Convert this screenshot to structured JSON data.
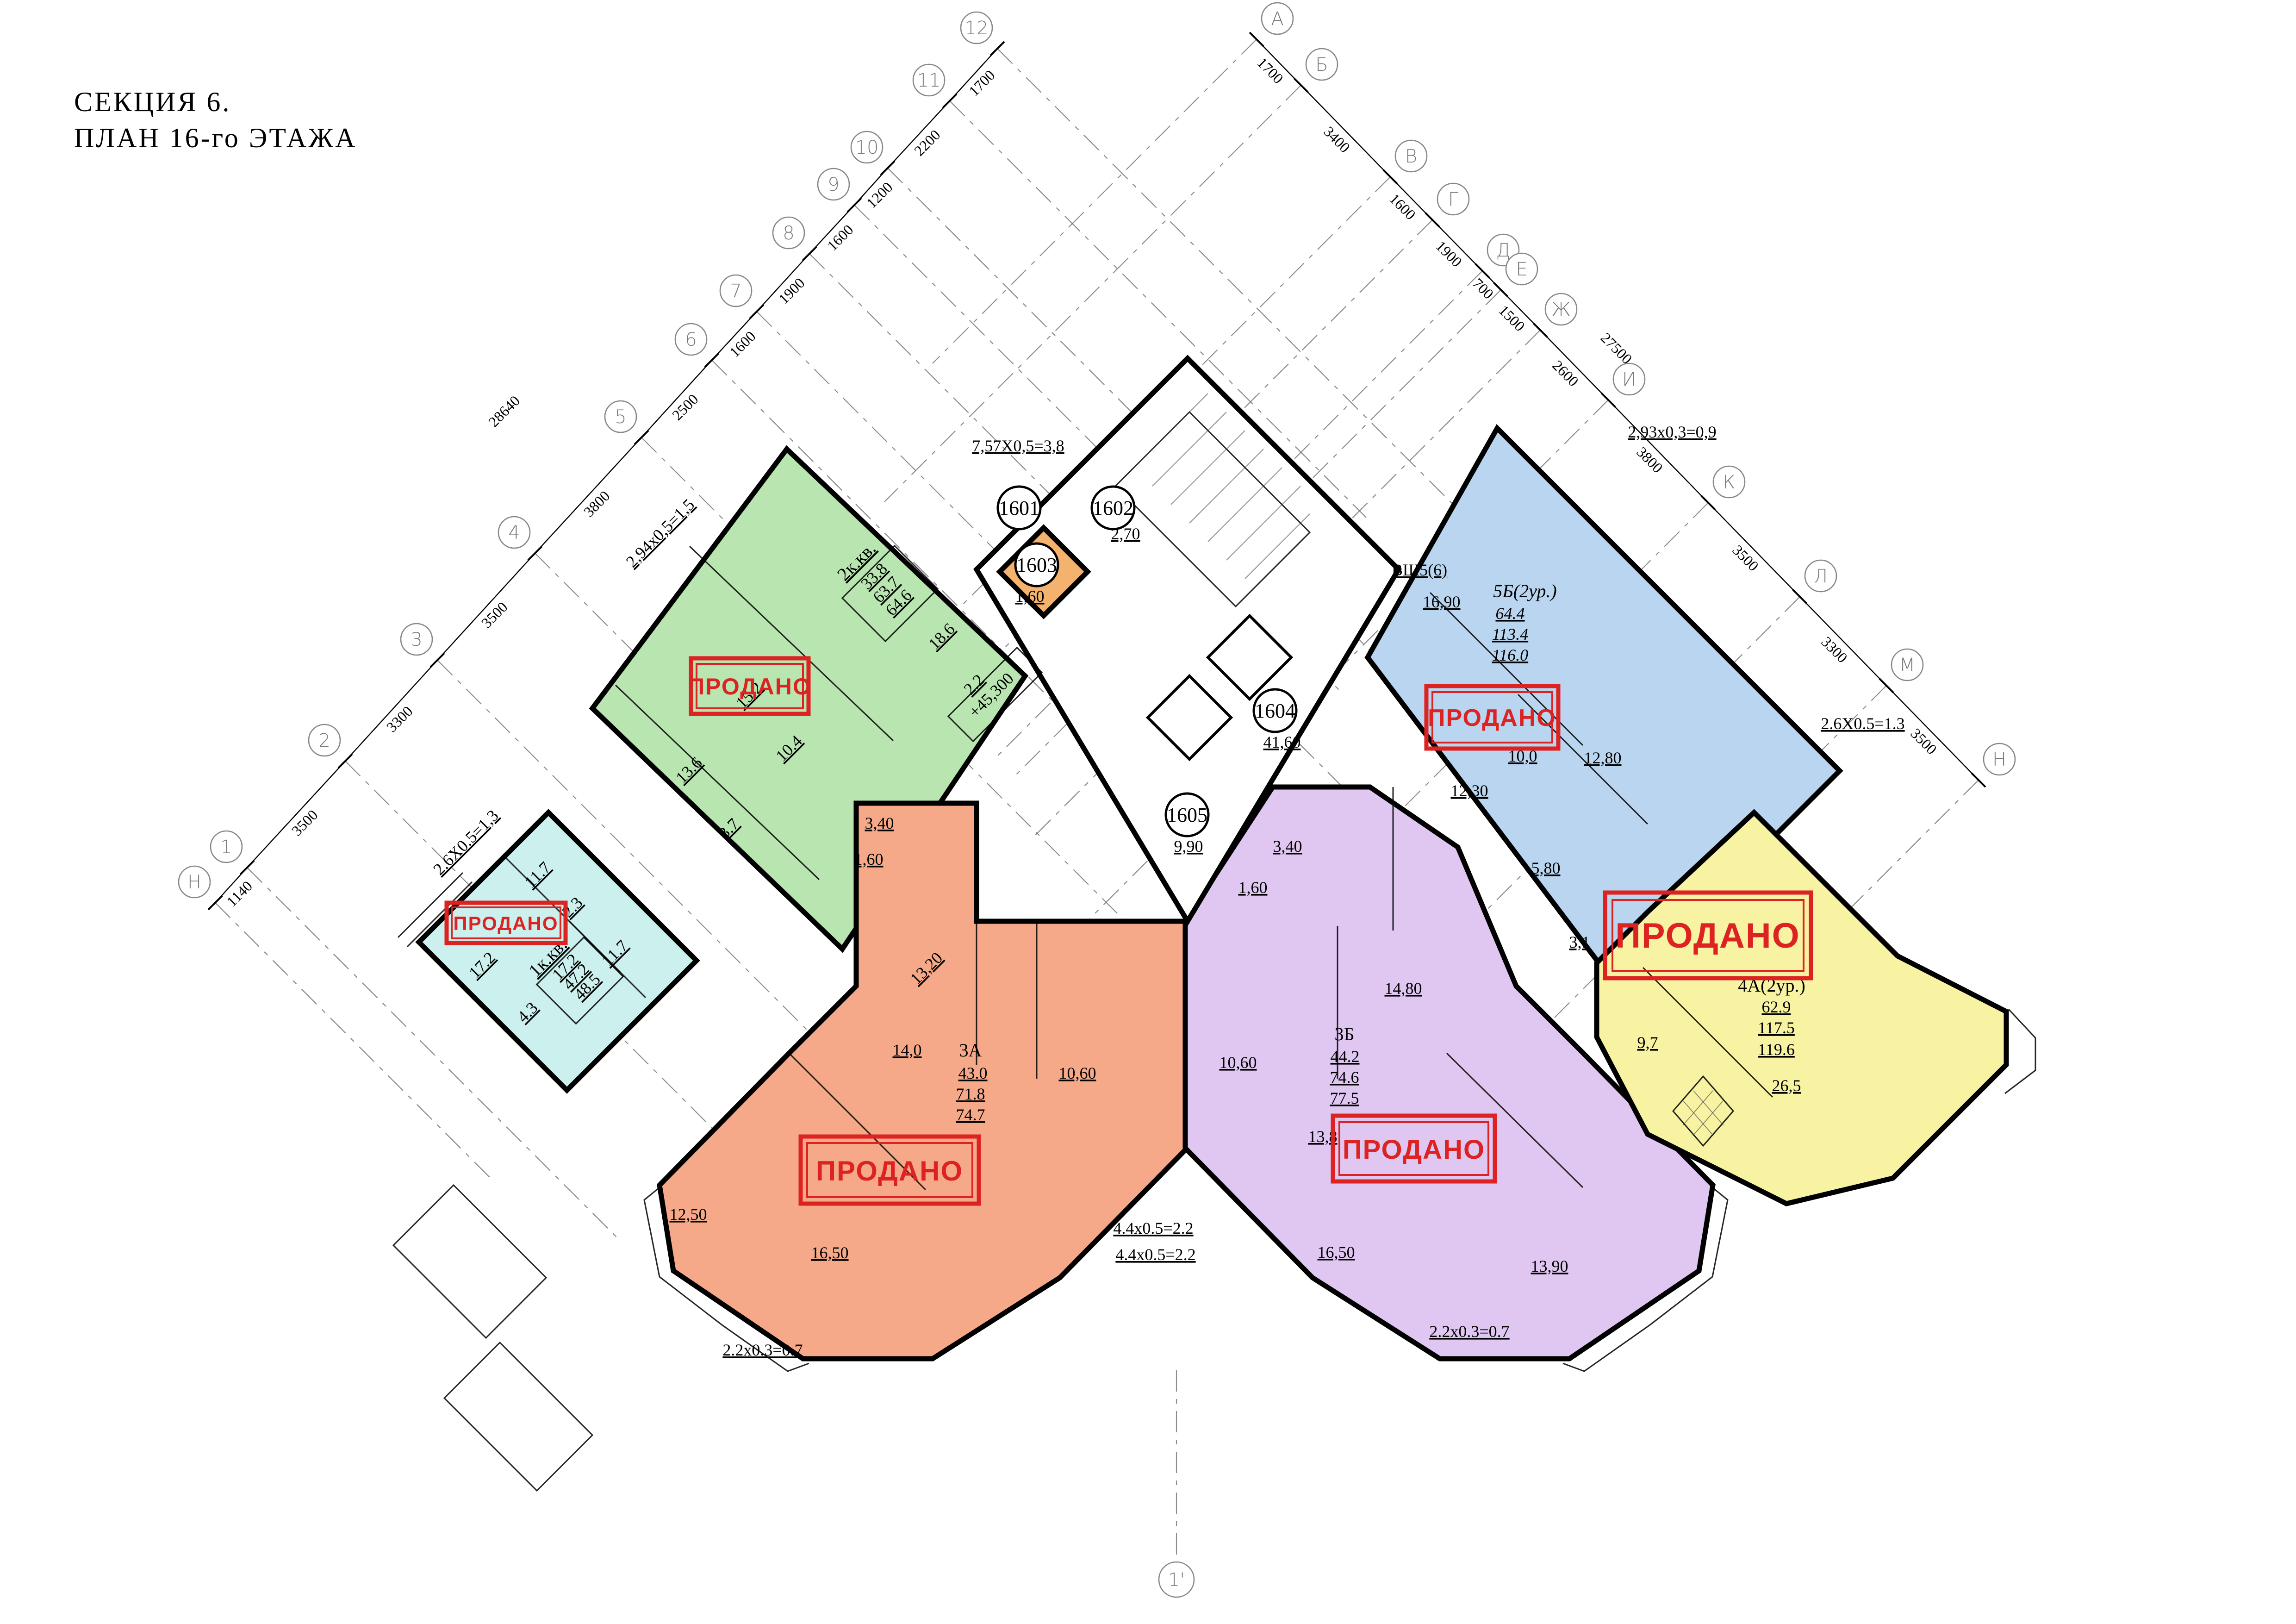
{
  "title": {
    "line1": "СЕКЦИЯ  6.",
    "line2": "ПЛАН  16-го ЭТАЖА"
  },
  "stamp": "ПРОДАНО",
  "colors": {
    "green": "#b9e5b1",
    "cyan": "#ccf0ee",
    "orange": "#f5a988",
    "purple": "#e0c7f2",
    "blue": "#b9d5ef",
    "yellow": "#f8f3a2",
    "shaft": "#f3b26d",
    "stamp_red": "#dd2222"
  },
  "units": {
    "green": {
      "name": "2к.кв.",
      "a1": "33.8",
      "a2": "63.7",
      "a3": "64.6",
      "r1": "15.2",
      "r2": "10.4",
      "r3": "13.6",
      "r4": "3.7",
      "r5": "18.6",
      "r6": "2.2",
      "balcony": "2,94х0,5=1,5"
    },
    "cyan": {
      "name": "1к.кв.",
      "a1": "17.2",
      "a2": "47.2",
      "a3": "48.5",
      "r1": "11.7",
      "r2": "2.3",
      "r3": "11.7",
      "r4": "17.2",
      "r5": "4.3",
      "balcony": "2.6Х0.5=1,3"
    },
    "orange": {
      "name": "3А",
      "a1": "43.0",
      "a2": "71.8",
      "a3": "74.7",
      "r1": "13,20",
      "r2": "3,40",
      "r3": "1,60",
      "r4": "14,0",
      "r5": "10,60",
      "r6": "12,50",
      "r7": "16,50",
      "balcony": "2.2х0.3=0.7"
    },
    "purple": {
      "name": "3Б",
      "a1": "44.2",
      "a2": "74.6",
      "a3": "77.5",
      "r1": "3,40",
      "r2": "1,60",
      "r3": "10,60",
      "r4": "14,80",
      "r5": "13,8",
      "r6": "16,50",
      "r7": "13,90",
      "balcony": "2.2х0.3=0.7"
    },
    "blue": {
      "name": "5Б(2ур.)",
      "a1": "64.4",
      "a2": "113.4",
      "a3": "116.0",
      "vsh": "ВШ5(6)",
      "r1": "16,90",
      "r2": "10,0",
      "r3": "12,80",
      "r4": "12,30",
      "r5": "5,80",
      "balcony": "2,93х0,3=0,9"
    },
    "yellow": {
      "name": "4А(2ур.)",
      "a1": "62.9",
      "a2": "117.5",
      "a3": "119.6",
      "r1": "3,1",
      "r2": "9,7",
      "r3": "26,5",
      "balcony": "2.6Х0.5=1.3"
    }
  },
  "core": {
    "c1601": "1601",
    "c1602": "1602",
    "c1602_dim": "2,70",
    "c1603": "1603",
    "c1603_dim": "1,60",
    "c1604": "1604",
    "c1604_dim": "41,60",
    "c1605": "1605",
    "c1605_dim": "9,90",
    "level": "+45,300",
    "top_dim": "7,57Х0,5=3,8"
  },
  "axes": {
    "numbers": [
      "1",
      "2",
      "3",
      "4",
      "5",
      "6",
      "7",
      "8",
      "9",
      "10",
      "11",
      "12"
    ],
    "letters": [
      "А",
      "Б",
      "В",
      "Г",
      "Д",
      "Е",
      "Ж",
      "И",
      "К",
      "Л",
      "М"
    ],
    "axis_n": "Н",
    "bottom": "1'",
    "dims_nw": [
      "1140",
      "3500",
      "3300",
      "3500",
      "3800",
      "2500",
      "1600",
      "1900",
      "1600",
      "1200",
      "2200",
      "1700"
    ],
    "overall_nw": "28640",
    "dims_ne": [
      "1700",
      "3400",
      "1600",
      "1900",
      "700",
      "1500",
      "2600",
      "3800",
      "3500",
      "3300",
      "3500"
    ],
    "overall_ne": "27500"
  }
}
